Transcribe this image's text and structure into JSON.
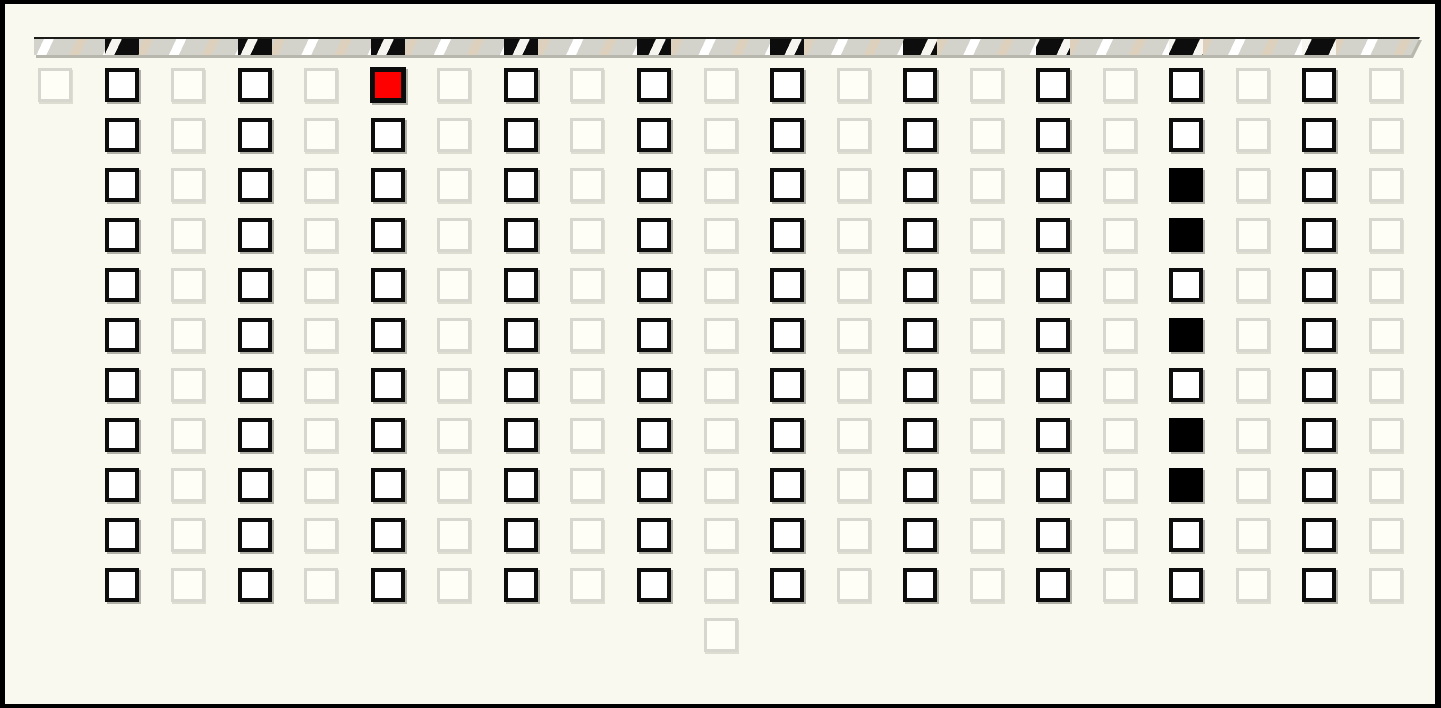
{
  "colors": {
    "background": "#faf9ef",
    "frame": "#000000",
    "inactive_border": "#d7d7cf",
    "inactive_fill": "#fefdf6",
    "active_border": "#0d0d0d",
    "cell_fill": "#ffffff",
    "selected_red": "#ff0000",
    "filled_black": "#000000",
    "bar_gray": "#d3d3cb",
    "bar_stripe_white": "#ffffff",
    "bar_stripe_tan": "#ddd1bd",
    "bar_segment_black": "#0d0d0d",
    "bar_stripe_brown": "#8a4a26"
  },
  "hazard_bar": {
    "segment_columns": [
      2,
      4,
      6,
      8,
      10,
      12,
      14,
      16,
      18,
      20
    ]
  },
  "grid": {
    "columns": 21,
    "rows": 12,
    "cell_codes": {
      ".": "empty-light-cell",
      "W": "empty-active-cell",
      "K": "filled-black-cell",
      "R": "selected-red-cell",
      "-": "no-cell"
    },
    "cells": [
      ".W.W.R.W.W.W.W.W.W.W.",
      "-W.W.W.W.W.W.W.W.W.W.",
      "-W.W.W.W.W.W.W.W.K.W.",
      "-W.W.W.W.W.W.W.W.K.W.",
      "-W.W.W.W.W.W.W.W.W.W.",
      "-W.W.W.W.W.W.W.W.K.W.",
      "-W.W.W.W.W.W.W.W.W.W.",
      "-W.W.W.W.W.W.W.W.K.W.",
      "-W.W.W.W.W.W.W.W.K.W.",
      "-W.W.W.W.W.W.W.W.W.W.",
      "-W.W.W.W.W.W.W.W.W.W.",
      "----------.----------"
    ]
  }
}
